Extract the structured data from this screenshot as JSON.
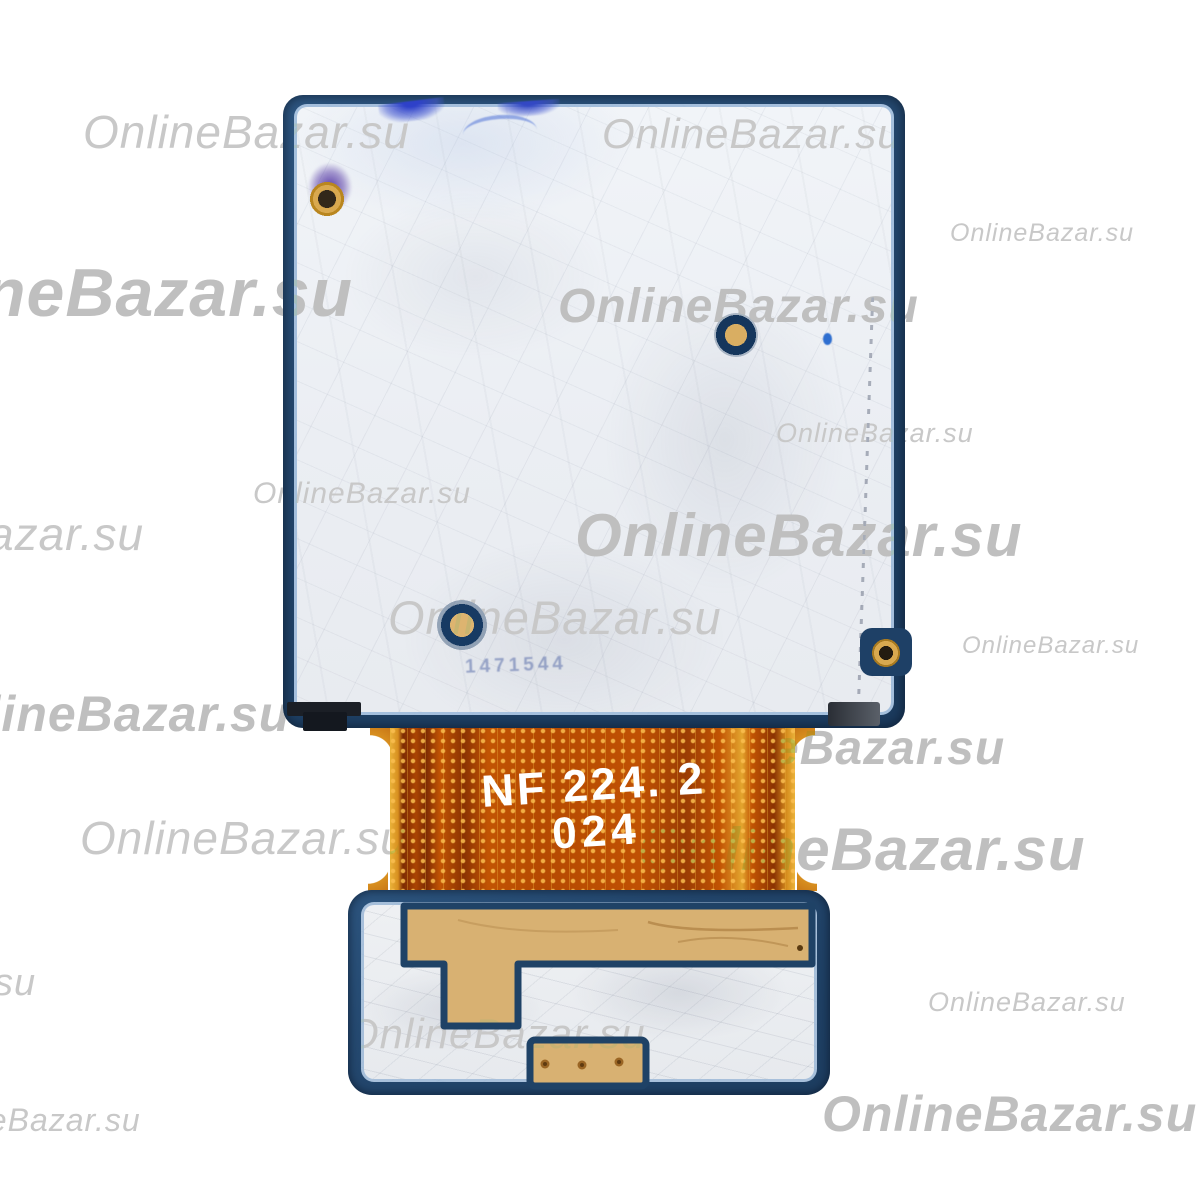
{
  "canvas": {
    "width": 1200,
    "height": 1200,
    "background": "#ffffff"
  },
  "flex_text": {
    "line1": "NF 224. 2",
    "line2": "024",
    "color": "#ffffff"
  },
  "colors": {
    "shield_navy": "#22456b",
    "label_white": "#eef1f5",
    "flex_orange": "#c25403",
    "flex_dark_red": "#8a3202",
    "flex_gold_edge": "#e9b23a",
    "copper_tan": "#d8b172",
    "screw_gold": "#d9a94f",
    "watermark_gray": "#c6c6c6",
    "paint_blue": "#2e41c9",
    "paint_purple": "#5b3fa8"
  },
  "watermarks": [
    {
      "text": "OnlineBazar.su",
      "x": 83,
      "y": 108,
      "size": 46,
      "weight": 500
    },
    {
      "text": "OnlineBazar.su",
      "x": 602,
      "y": 112,
      "size": 42,
      "weight": 500
    },
    {
      "text": "OnlineBazar.su",
      "x": 950,
      "y": 220,
      "size": 25,
      "weight": 500
    },
    {
      "text": "neBazar.su",
      "x": -16,
      "y": 258,
      "size": 68,
      "weight": 700
    },
    {
      "text": "OnlineBazar.su",
      "x": 558,
      "y": 282,
      "size": 48,
      "weight": 700
    },
    {
      "text": "OnlineBazar.su",
      "x": 776,
      "y": 419,
      "size": 27,
      "weight": 500
    },
    {
      "text": "azar.su",
      "x": -12,
      "y": 510,
      "size": 46,
      "weight": 500
    },
    {
      "text": "OnlineBazar.su",
      "x": 575,
      "y": 504,
      "size": 60,
      "weight": 700
    },
    {
      "text": "OnlineBazar.su",
      "x": 253,
      "y": 478,
      "size": 30,
      "weight": 500
    },
    {
      "text": "OnlineBazar.su",
      "x": 962,
      "y": 633,
      "size": 24,
      "weight": 500
    },
    {
      "text": "OnlineBazar.su",
      "x": 388,
      "y": 593,
      "size": 47,
      "weight": 500
    },
    {
      "text": "nlineBazar.su",
      "x": -45,
      "y": 688,
      "size": 50,
      "weight": 700
    },
    {
      "text": "eBazar.su",
      "x": 772,
      "y": 724,
      "size": 48,
      "weight": 700
    },
    {
      "text": "OnlineBazar.su",
      "x": 80,
      "y": 814,
      "size": 46,
      "weight": 500
    },
    {
      "text": "OnlineBazar.su",
      "x": 638,
      "y": 818,
      "size": 60,
      "weight": 700
    },
    {
      "text": "su",
      "x": -6,
      "y": 964,
      "size": 38,
      "weight": 500
    },
    {
      "text": "OnlineBazar.su",
      "x": 346,
      "y": 1012,
      "size": 42,
      "weight": 500
    },
    {
      "text": "OnlineBazar.su",
      "x": 928,
      "y": 988,
      "size": 27,
      "weight": 500
    },
    {
      "text": "OnlineBazar.su",
      "x": 822,
      "y": 1088,
      "size": 50,
      "weight": 700
    },
    {
      "text": "neBazar.su",
      "x": -30,
      "y": 1104,
      "size": 32,
      "weight": 500
    }
  ],
  "board_marking": "1471544"
}
